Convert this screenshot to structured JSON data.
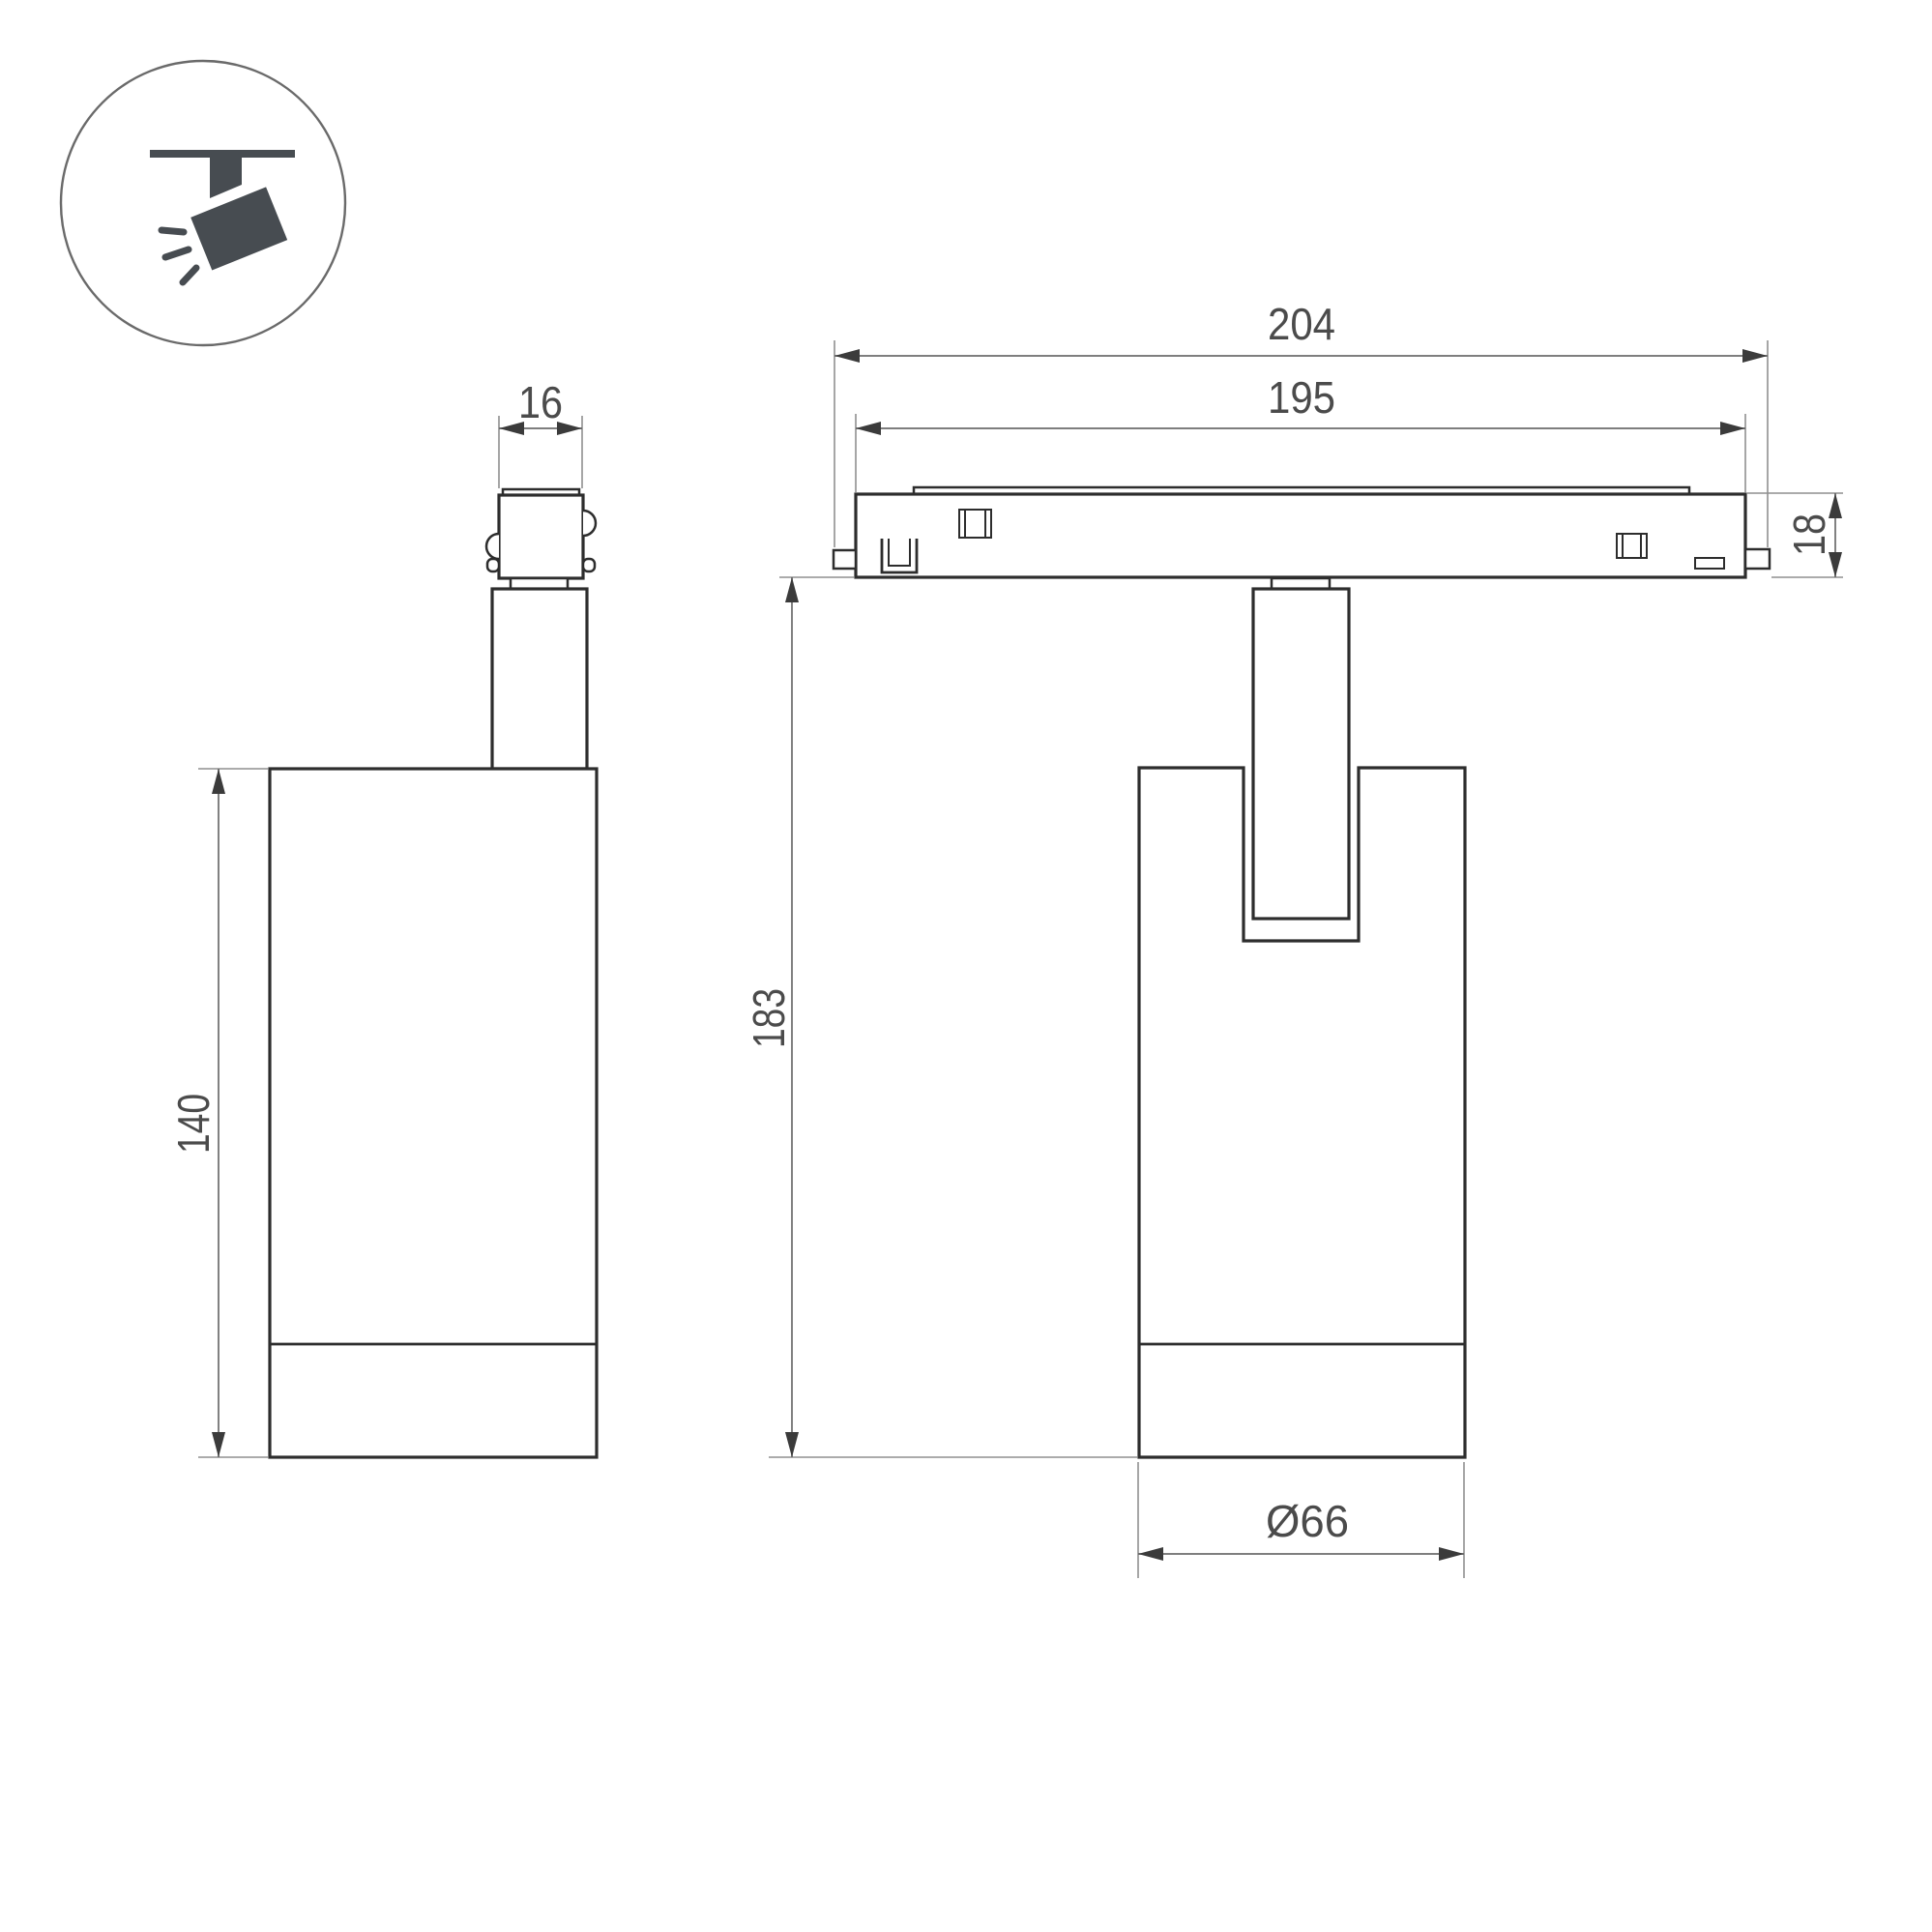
{
  "page": {
    "type": "technical-dimension-drawing",
    "subject": "magnetic-track-spotlight"
  },
  "icon": {
    "name": "ceiling-track-spotlight-pictogram"
  },
  "dimensions": {
    "side_view": {
      "adapter_width": "16",
      "body_height": "140"
    },
    "front_view": {
      "track_outer_length": "204",
      "track_inner_length": "195",
      "track_height": "18",
      "total_height": "183",
      "body_diameter": "Ø66"
    }
  },
  "colors": {
    "outline": "#2d2d2d",
    "ext": "#8f8f8f",
    "dimline": "#6b6b6b",
    "arrow": "#3b3b3b",
    "text": "#4b4b4b",
    "icon": "#474c51",
    "icon_circle": "#6a6a6a",
    "background": "#ffffff"
  }
}
